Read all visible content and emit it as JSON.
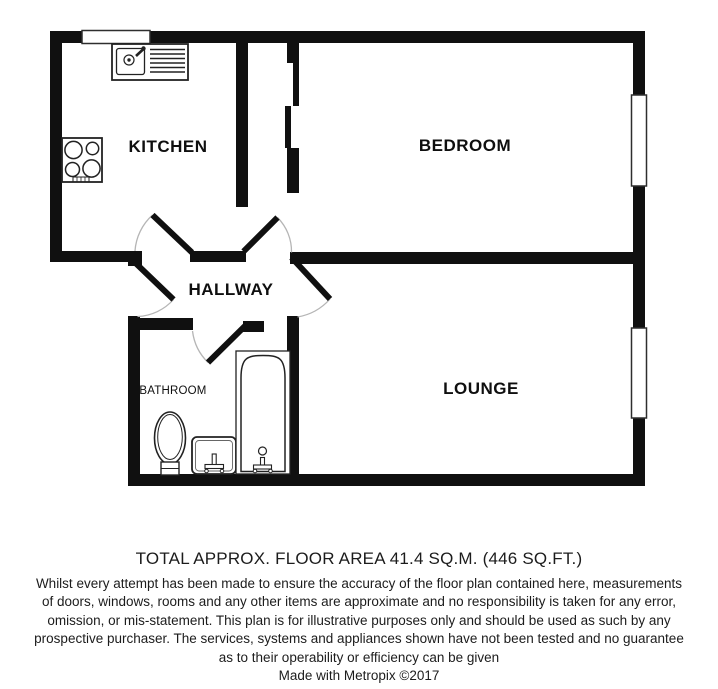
{
  "floor_plan": {
    "rooms": {
      "kitchen": {
        "label": "KITCHEN"
      },
      "bedroom": {
        "label": "BEDROOM"
      },
      "hallway": {
        "label": "HALLWAY"
      },
      "bathroom": {
        "label": "BATHROOM"
      },
      "lounge": {
        "label": "LOUNGE"
      }
    },
    "fixtures": [
      "kitchen-sink-drainer-unit",
      "hob-4-burners",
      "toilet",
      "wash-basin",
      "bathtub"
    ],
    "windows": [
      "kitchen-top-window",
      "bedroom-right-window",
      "lounge-right-window"
    ],
    "doors": [
      "entrance-door",
      "kitchen-door",
      "bedroom-door",
      "lounge-door",
      "bathroom-door"
    ],
    "colors": {
      "wall": "#101010",
      "background": "#ffffff",
      "fixture_outline": "#222222",
      "door_swing_arc": "#b5b5b5"
    }
  },
  "caption": {
    "area_line": "TOTAL APPROX. FLOOR AREA 41.4 SQ.M. (446 SQ.FT.)",
    "disclaimer_lines": [
      "Whilst every attempt has been made to ensure the accuracy of the floor plan contained here, measurements",
      "of doors, windows, rooms and any other items are approximate and no responsibility is taken for any error,",
      "omission, or mis-statement. This plan is for illustrative purposes only and should be used as such by any",
      "prospective purchaser. The services, systems and appliances shown have not been tested and no guarantee",
      "as to their operability or efficiency can be given"
    ],
    "credit_line": "Made with Metropix ©2017"
  }
}
